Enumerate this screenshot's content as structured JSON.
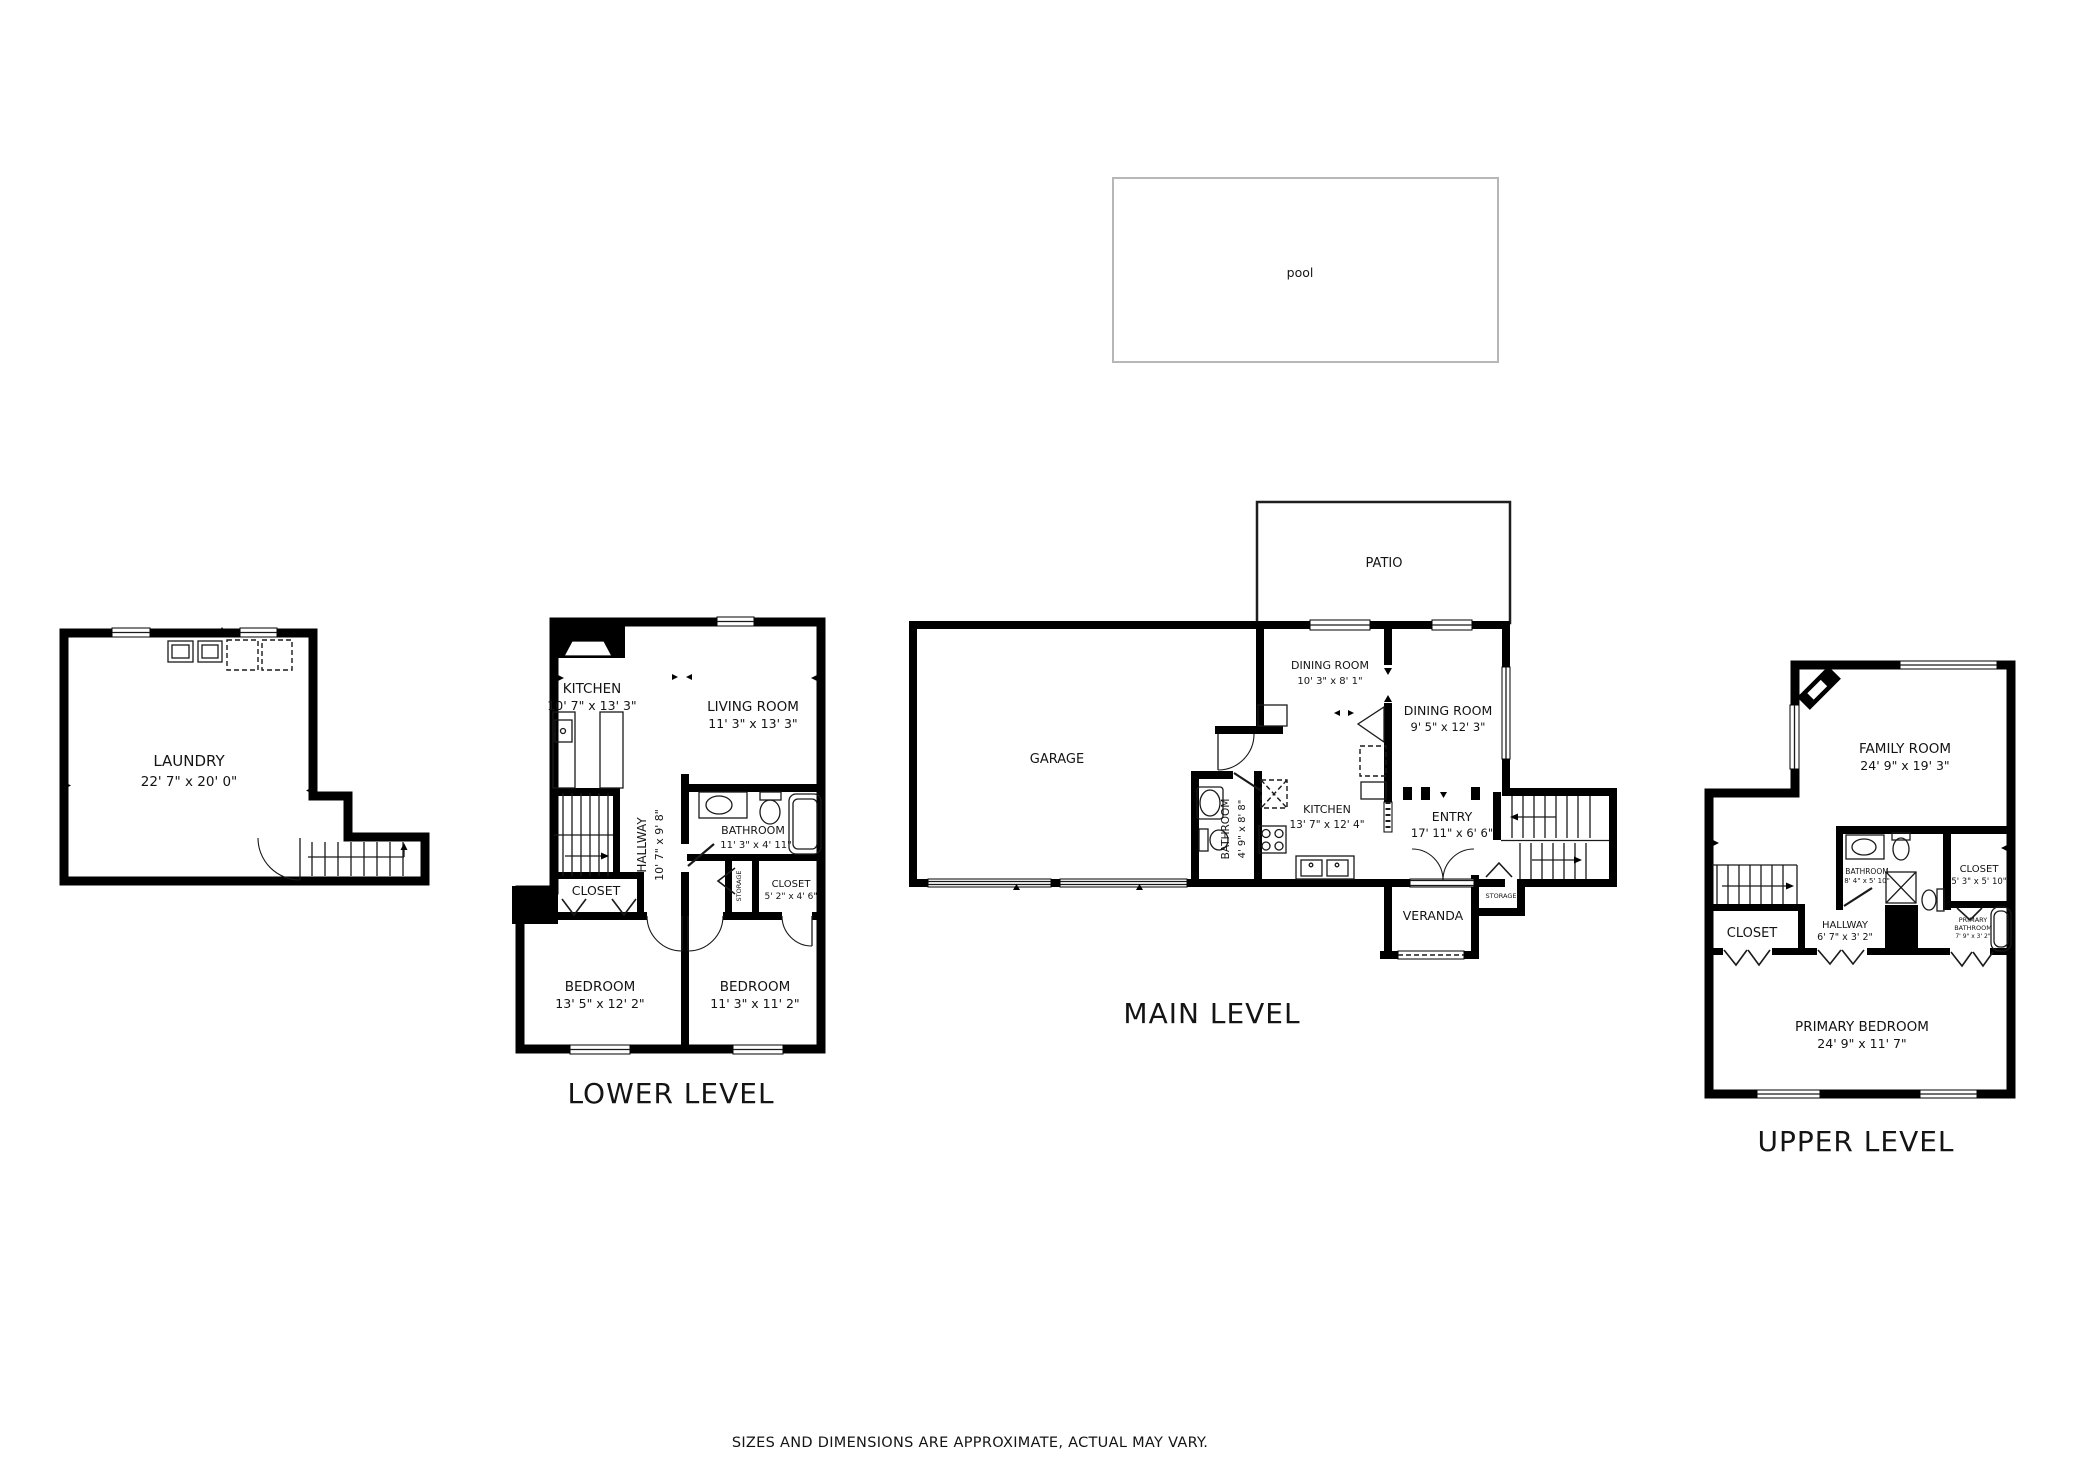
{
  "disclaimer": "SIZES AND DIMENSIONS ARE APPROXIMATE, ACTUAL MAY VARY.",
  "pool": {
    "label": "pool"
  },
  "levels": {
    "lower": {
      "title": "LOWER LEVEL",
      "rooms": {
        "laundry": {
          "name": "LAUNDRY",
          "dims": "22' 7\" x 20' 0\""
        },
        "kitchen": {
          "name": "KITCHEN",
          "dims": "10' 7\" x 13' 3\""
        },
        "living": {
          "name": "LIVING ROOM",
          "dims": "11' 3\" x 13' 3\""
        },
        "hallway": {
          "name": "HALLWAY",
          "dims": "10' 7\" x 9' 8\""
        },
        "bathroom": {
          "name": "BATHROOM",
          "dims": "11' 3\" x 4' 11\""
        },
        "closet": {
          "name": "CLOSET"
        },
        "storage": {
          "name": "STORAGE"
        },
        "closet2": {
          "name": "CLOSET",
          "dims": "5' 2\" x 4' 6\""
        },
        "bedroom1": {
          "name": "BEDROOM",
          "dims": "13' 5\" x 12' 2\""
        },
        "bedroom2": {
          "name": "BEDROOM",
          "dims": "11' 3\" x 11' 2\""
        }
      }
    },
    "main": {
      "title": "MAIN LEVEL",
      "rooms": {
        "patio": {
          "name": "PATIO"
        },
        "garage": {
          "name": "GARAGE"
        },
        "dining1": {
          "name": "DINING ROOM",
          "dims": "10' 3\" x 8' 1\""
        },
        "dining2": {
          "name": "DINING ROOM",
          "dims": "9' 5\" x 12' 3\""
        },
        "bathroom": {
          "name": "BATHROOM",
          "dims": "4' 9\" x 8' 8\""
        },
        "kitchen": {
          "name": "KITCHEN",
          "dims": "13' 7\" x 12' 4\""
        },
        "entry": {
          "name": "ENTRY",
          "dims": "17' 11\" x 6' 6\""
        },
        "storage": {
          "name": "STORAGE"
        },
        "veranda": {
          "name": "VERANDA"
        }
      }
    },
    "upper": {
      "title": "UPPER LEVEL",
      "rooms": {
        "family": {
          "name": "FAMILY ROOM",
          "dims": "24' 9\" x 19' 3\""
        },
        "bathroom": {
          "name": "BATHROOM",
          "dims": "8' 4\" x 5' 10\""
        },
        "closet1": {
          "name": "CLOSET",
          "dims": "5' 3\" x 5' 10\""
        },
        "closet2": {
          "name": "CLOSET"
        },
        "hallway": {
          "name": "HALLWAY",
          "dims": "6' 7\" x 3' 2\""
        },
        "primary_bathroom": {
          "name1": "PRIMARY",
          "name2": "BATHROOM",
          "dims": "7' 9\" x 3' 2\""
        },
        "primary_bedroom": {
          "name": "PRIMARY BEDROOM",
          "dims": "24' 9\" x 11' 7\""
        }
      }
    }
  },
  "colors": {
    "wall": "#000000",
    "text": "#141414",
    "disclaimer": "#808080",
    "pool_outline": "#b7b7b7"
  }
}
